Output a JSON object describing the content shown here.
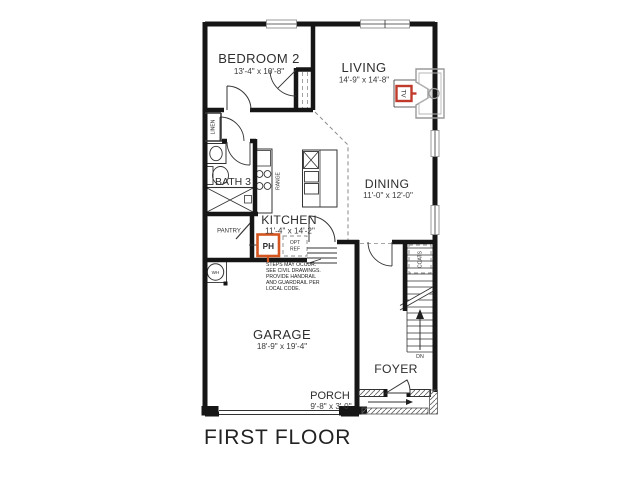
{
  "title": "FIRST FLOOR",
  "rooms": {
    "bedroom2": {
      "name": "BEDROOM 2",
      "dims": "13'-4\" x 10'-8\""
    },
    "living": {
      "name": "LIVING",
      "dims": "14'-9\" x 14'-8\""
    },
    "bath3": {
      "name": "BATH 3"
    },
    "kitchen": {
      "name": "KITCHEN",
      "dims": "11'-4\" x 14'-2\""
    },
    "dining": {
      "name": "DINING",
      "dims": "11'-0\" x 12'-0\""
    },
    "garage": {
      "name": "GARAGE",
      "dims": "18'-9\" x 19'-4\""
    },
    "foyer": {
      "name": "FOYER"
    },
    "porch": {
      "name": "PORCH",
      "dims": "9'-8\" x 3'-0\""
    }
  },
  "labels": {
    "linen": "LINEN",
    "range": "RANGE",
    "pantry": "PANTRY",
    "coats": "COATS",
    "wh": "WH",
    "dn": "DN",
    "ph": "PH",
    "tv": "TV",
    "opt": "OPT",
    "ref": "REF"
  },
  "note": {
    "lines": [
      "STEPS MAY OCCUR.",
      "SEE CIVIL DRAWINGS.",
      "PROVIDE HANDRAIL",
      "AND GUARDRAIL PER",
      "LOCAL CODE."
    ]
  },
  "colors": {
    "wall": "#161616",
    "marker_red": "#c03a2b",
    "marker_orange": "#d4551f",
    "fixture_gray": "#9a9a9a"
  }
}
